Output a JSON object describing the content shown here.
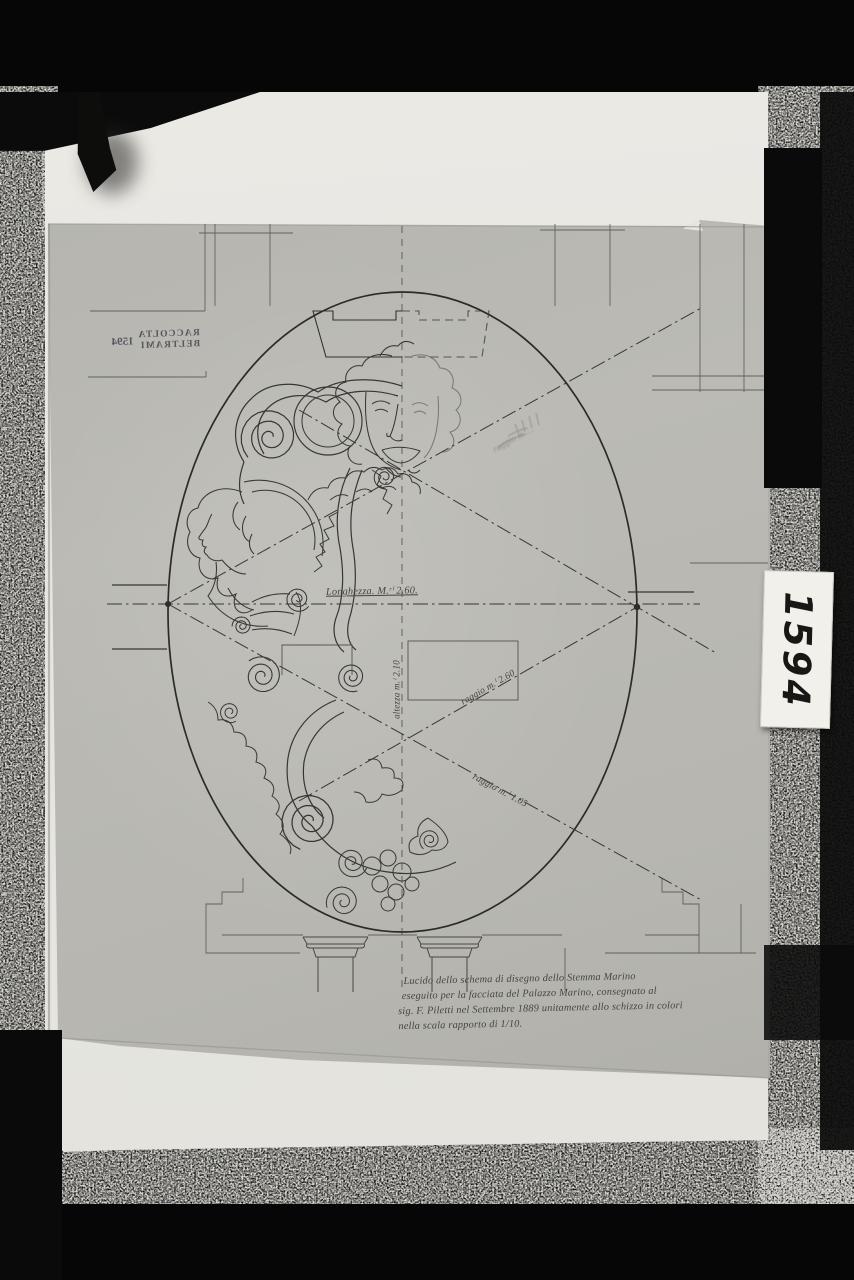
{
  "photo": {
    "stamp": {
      "line1": "RACCOLTA",
      "line2": "BELTRAMI",
      "number": "1594"
    },
    "catalog_label": "1594",
    "dimensions": {
      "length": "Longhezza. M.ʳⁱ 2.60.",
      "height": "altezza m.ⁱ 2.10",
      "radius_mid": "raggio m.ⁱ 2.60",
      "radius_lower": "raggio m.ⁱ 1.05",
      "radius_upper_pencil": "raggio m …"
    },
    "caption_lines": [
      "Lucido dello schema di disegno dello Stemma Marino",
      "eseguito per la facciata del Palazzo Marino, consegnato al",
      "sig. F. Piletti nel Settembre 1889 unitamente allo schizzo in colori",
      "nella scala rapporto di 1/10."
    ],
    "colors": {
      "paper": "#e8e7e2",
      "sheet": "#b9b8b2",
      "ink": "#34322e",
      "background": "#070707"
    }
  }
}
